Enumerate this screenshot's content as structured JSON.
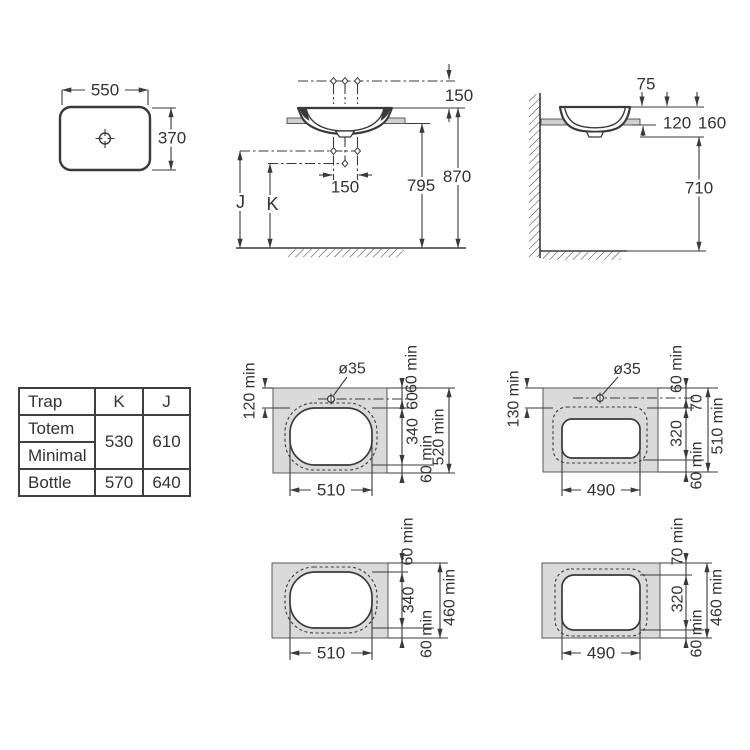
{
  "colors": {
    "line": "#3a3a3a",
    "counter_fill": "#dadada",
    "text": "#333333",
    "background": "#ffffff"
  },
  "top_view": {
    "width": "550",
    "depth": "370"
  },
  "front_view": {
    "faucet_height": "150",
    "faucet_spacing": "150",
    "total_height": "870",
    "counter_height": "795",
    "trap_dim_j": "J",
    "trap_dim_k": "K"
  },
  "side_view": {
    "rim_above_counter": "75",
    "counter_inset": "120",
    "bowl_depth": "160",
    "floor_clearance": "710"
  },
  "table": {
    "header": [
      "Trap",
      "K",
      "J"
    ],
    "body": [
      {
        "name": "Totem",
        "k": "530",
        "j": "610"
      },
      {
        "name": "Minimal"
      },
      {
        "name": "Bottle",
        "k": "570",
        "j": "640"
      }
    ]
  },
  "cutout_top_oval": {
    "hole": "ø35",
    "left_margin": "120 min",
    "top_margin": "60 min",
    "hole_to_cutout": "60",
    "cutout_depth": "340",
    "bottom_margin": "60 min",
    "total_depth": "520 min",
    "cutout_width": "510"
  },
  "cutout_top_rect": {
    "hole": "ø35",
    "left_margin": "130 min",
    "top_margin": "60 min",
    "hole_to_cutout": "70",
    "cutout_depth": "320",
    "bottom_margin": "60 min",
    "total_depth": "510 min",
    "cutout_width": "490"
  },
  "cutout_bottom_oval": {
    "top_margin": "60 min",
    "cutout_depth": "340",
    "bottom_margin": "60 min",
    "total_depth": "460 min",
    "cutout_width": "510"
  },
  "cutout_bottom_rect": {
    "top_margin": "70 min",
    "cutout_depth": "320",
    "bottom_margin": "60 min",
    "total_depth": "460 min",
    "cutout_width": "490"
  }
}
